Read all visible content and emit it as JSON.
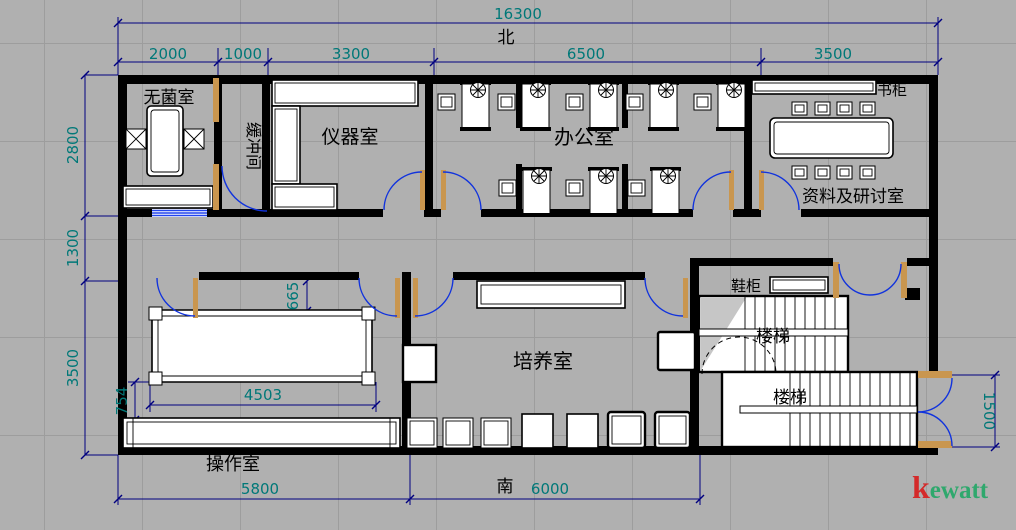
{
  "compass": {
    "north": "北",
    "south": "南"
  },
  "rooms": {
    "sterile": "无菌室",
    "buffer": "缓冲间",
    "instrument": "仪器室",
    "office": "办公室",
    "archive": "资料及研讨室",
    "culture": "培养室",
    "operation": "操作室",
    "stair_upper": "楼梯",
    "stair_lower": "楼梯"
  },
  "cabinets": {
    "bookcase": "书柜",
    "shoe_cabinet": "鞋柜"
  },
  "dims": {
    "total": "16300",
    "top": [
      "2000",
      "1000",
      "3300",
      "6500",
      "3500"
    ],
    "left": [
      "2800",
      "1300",
      "3500"
    ],
    "bottom": [
      "5800",
      "6000"
    ],
    "right": "1500",
    "interior": [
      "4503",
      "665",
      "754"
    ]
  },
  "logo": {
    "first": "k",
    "rest": "ewatt"
  },
  "colors": {
    "background": "#b0b0b0",
    "grid": "#9d9d9d",
    "wall": "#000000",
    "dimension_line": "#000080",
    "dimension_text": "#007878",
    "door_arc": "#1133dd",
    "door_leaf": "#c9964f",
    "window": "#2244ee",
    "logo_first": "#d42a2a",
    "logo_rest": "#2fa86d"
  }
}
